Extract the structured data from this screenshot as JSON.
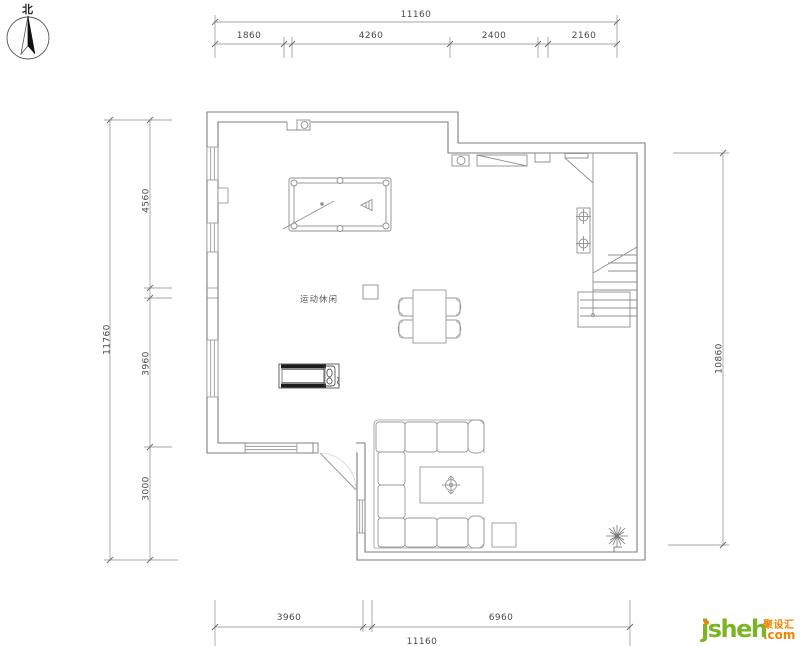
{
  "plan": {
    "north_label": "北",
    "room_label": "运动休闲"
  },
  "dimensions": {
    "top": {
      "total": "11160",
      "segments": [
        "1860",
        "4260",
        "2400",
        "2160"
      ]
    },
    "left": {
      "total": "11760",
      "segments": [
        "4560",
        "3960",
        "3000"
      ]
    },
    "right": {
      "total": "10860"
    },
    "bottom": {
      "total": "11160",
      "segments": [
        "3960",
        "6960"
      ]
    }
  },
  "logo": {
    "brand": "jsheh",
    "cn": "聚设汇",
    "suffix": ".com",
    "green": "#7cb426",
    "orange": "#f08300"
  }
}
